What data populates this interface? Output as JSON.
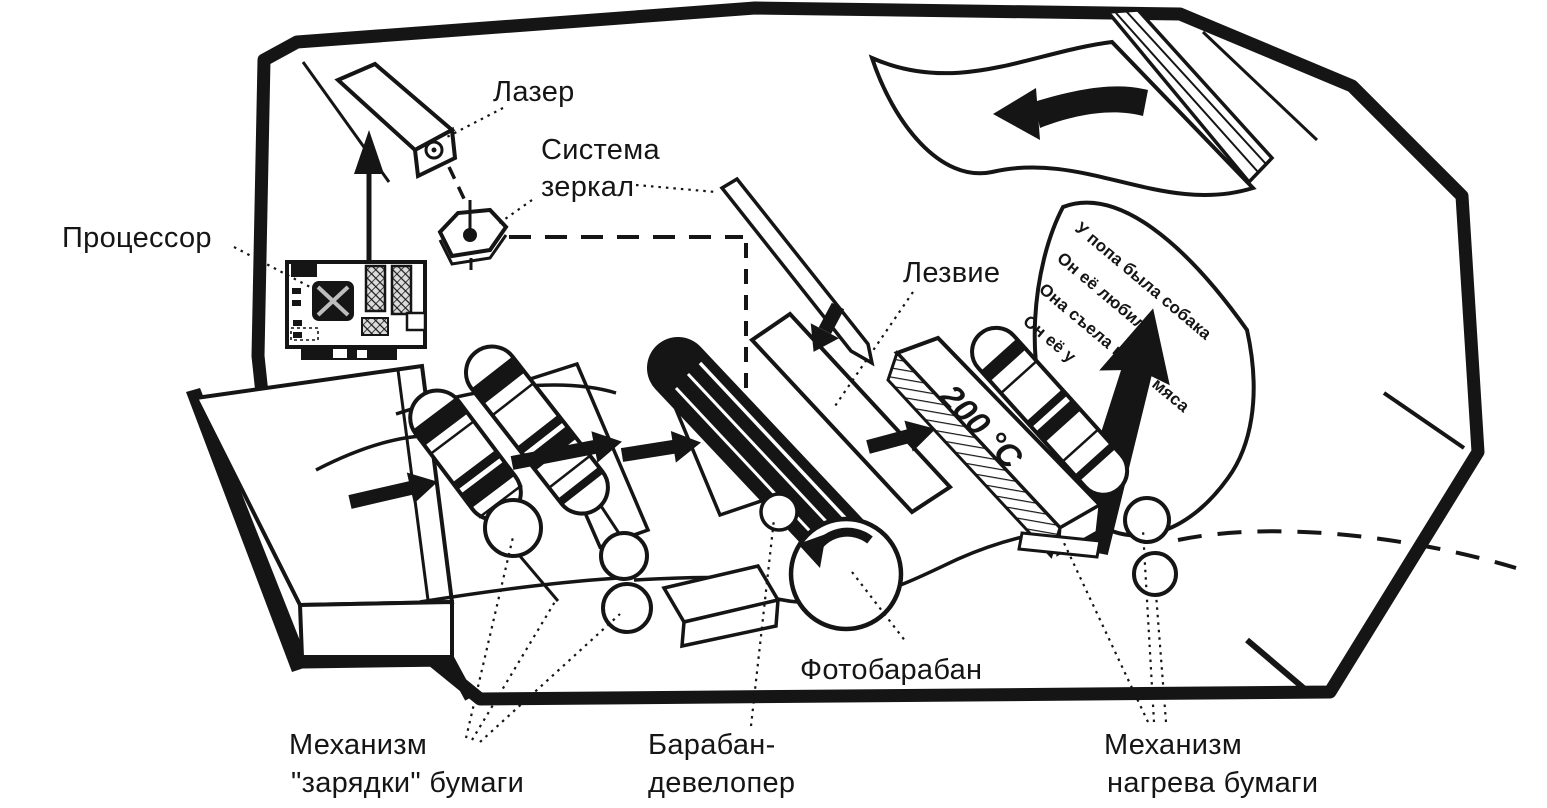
{
  "figure": {
    "background": "#ffffff",
    "ink_color": "#151515",
    "labels": {
      "laser": "Лазер",
      "mirror_system": [
        "Система",
        "зеркал"
      ],
      "processor": "Процессор",
      "blade": "Лезвие",
      "photo_drum": "Фотобарабан",
      "paper_charging": [
        "Механизм",
        "\"зарядки\" бумаги"
      ],
      "developer_drum": [
        "Барабан-",
        "девелопер"
      ],
      "paper_heating": [
        "Механизм",
        "нагрева бумаги"
      ],
      "temperature": "200 °C"
    },
    "printed_page": {
      "lines": [
        "У попа была собака",
        "Он её любил",
        "Она съела кусок мяса",
        "Он её у"
      ]
    }
  }
}
